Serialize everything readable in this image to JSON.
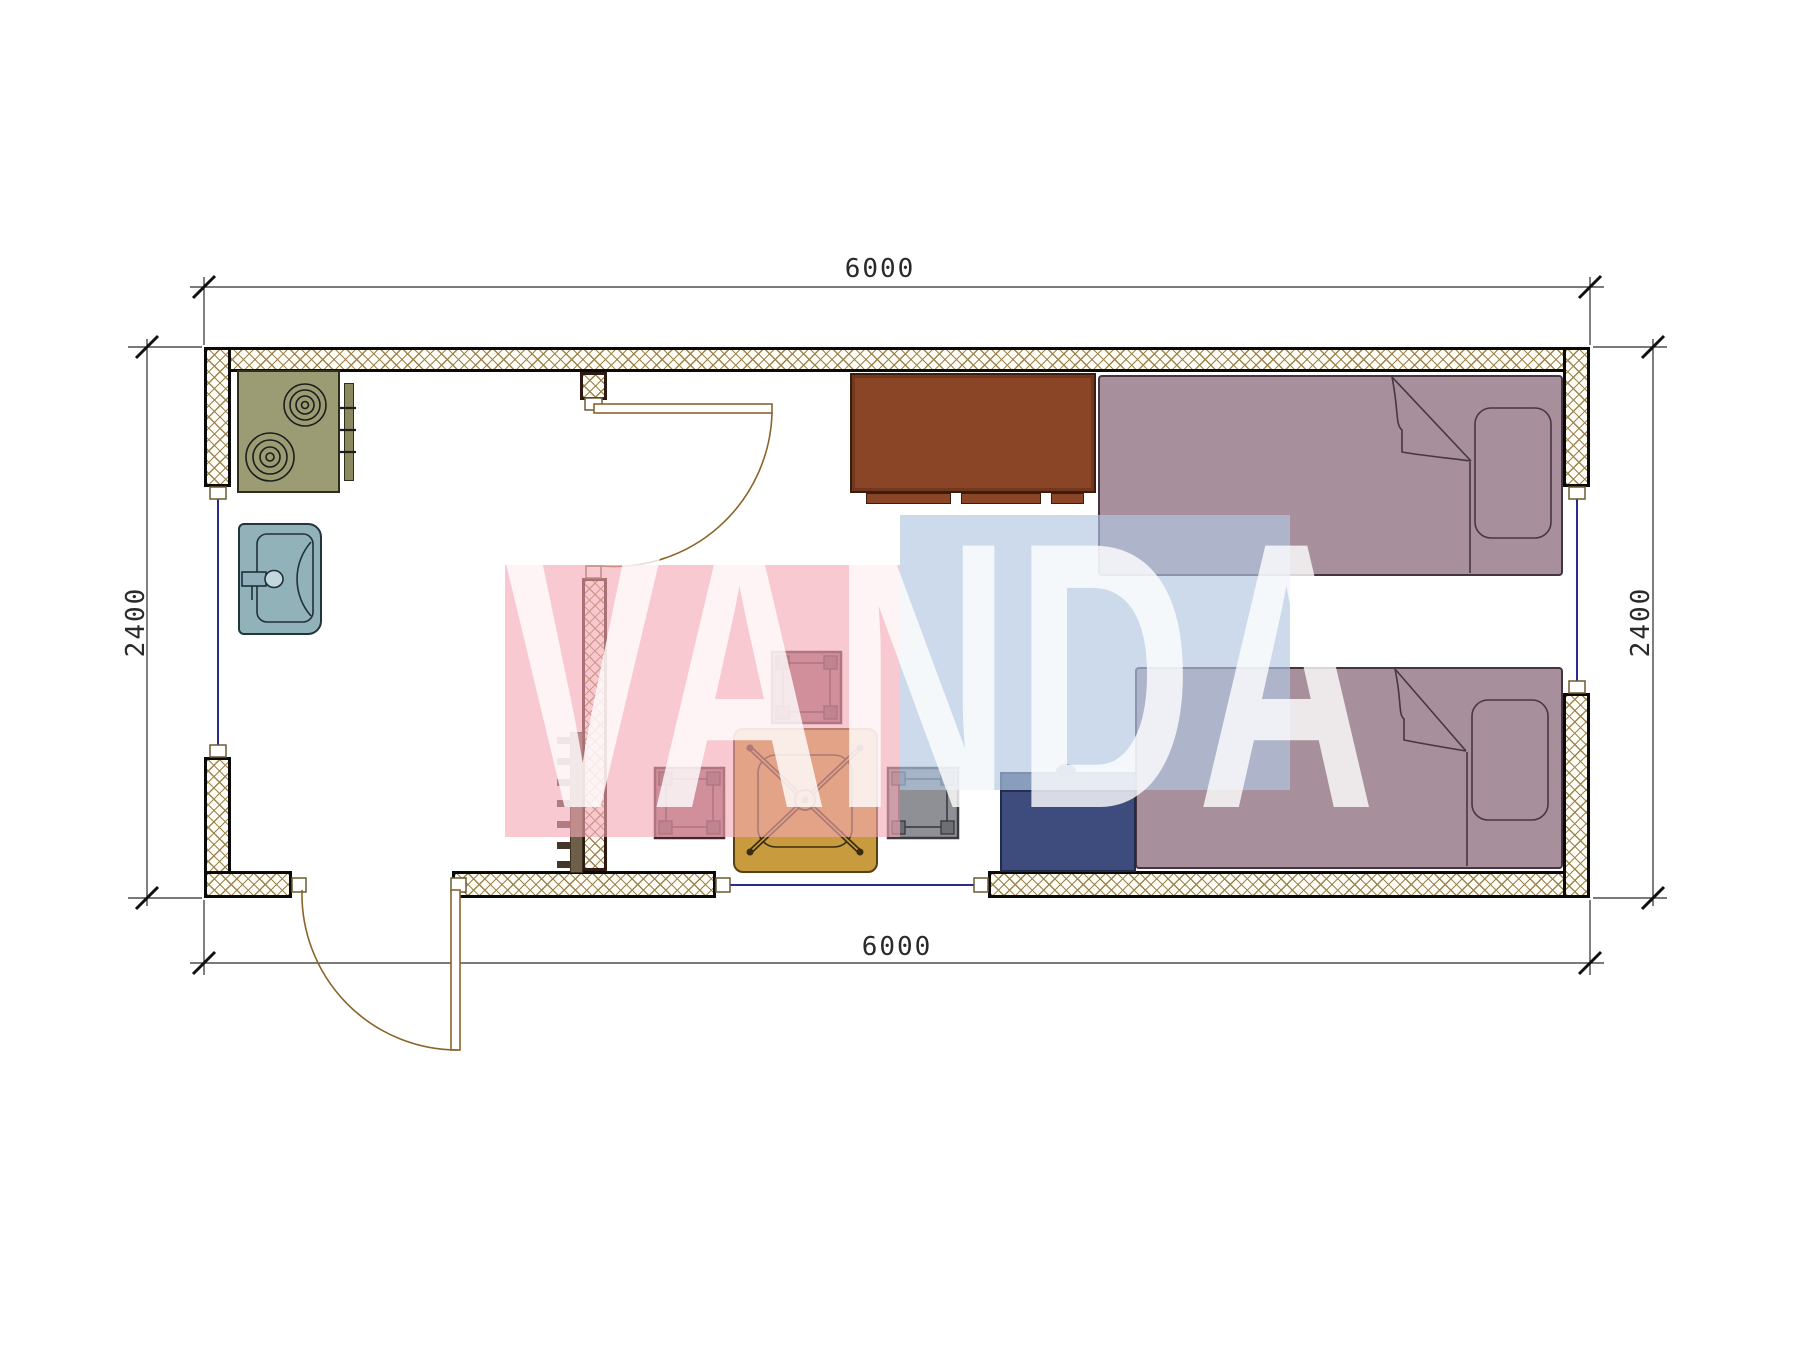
{
  "watermark": {
    "text": "VANDA",
    "pink_color": "#f3a8b4",
    "blue_color": "#b1c7e2",
    "text_color": "#ffffff"
  },
  "dimensions": {
    "top": "6000",
    "bottom": "6000",
    "left": "2400",
    "right": "2400"
  },
  "palette": {
    "wall_hatch": "#9a8450",
    "wall_outline": "#0a0a0a",
    "stove": "#9c9c74",
    "sink": "#92b2ba",
    "wardrobe": "#8a4526",
    "bed": "#a78f9b",
    "table": "#c79b3e",
    "stool": "#97686f",
    "cabinet": "#3d4c7c",
    "window_line": "#2b2b8f",
    "door_line": "#8a6428"
  }
}
